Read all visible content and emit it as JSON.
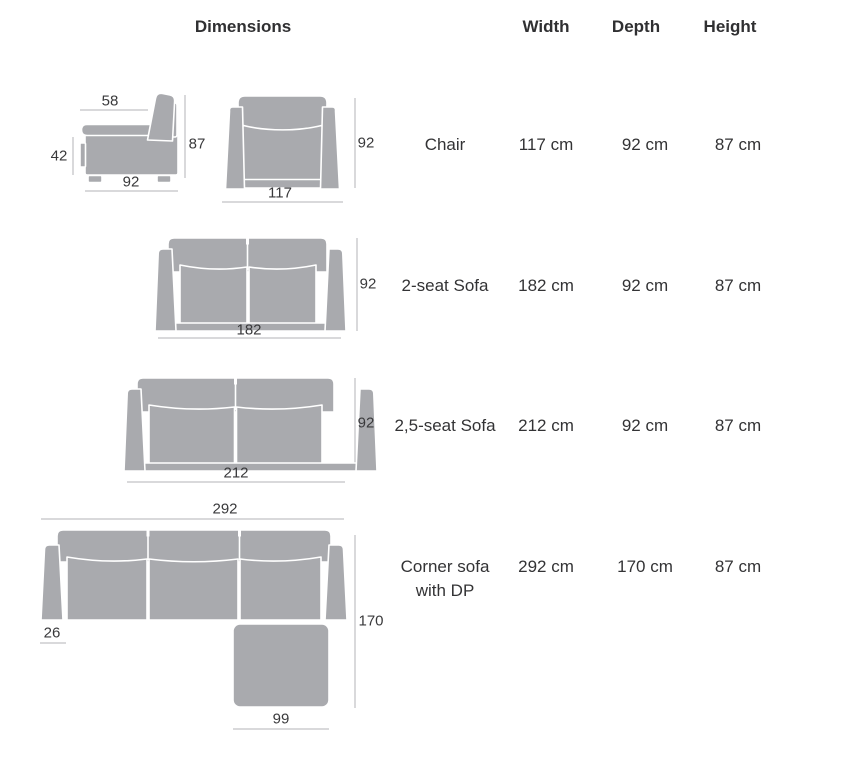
{
  "header": {
    "dimensions": "Dimensions",
    "width": "Width",
    "depth": "Depth",
    "height": "Height"
  },
  "rows": [
    {
      "name": "Chair",
      "name2": "",
      "width": "117 cm",
      "depth": "92 cm",
      "height": "87 cm"
    },
    {
      "name": "2-seat Sofa",
      "name2": "",
      "width": "182 cm",
      "depth": "92 cm",
      "height": "87 cm"
    },
    {
      "name": "2,5-seat Sofa",
      "name2": "",
      "width": "212 cm",
      "depth": "92 cm",
      "height": "87 cm"
    },
    {
      "name": "Corner sofa",
      "name2": "with DP",
      "width": "292 cm",
      "depth": "170 cm",
      "height": "87 cm"
    }
  ],
  "figures": {
    "chair_side": {
      "seat_depth": "58",
      "seat_height": "42",
      "total_height": "87",
      "total_depth": "92"
    },
    "chair_front": {
      "height": "92",
      "width": "117"
    },
    "sofa_2seat": {
      "height": "92",
      "width": "182"
    },
    "sofa_25seat": {
      "height": "92",
      "width": "212"
    },
    "corner_sofa": {
      "total_width": "292",
      "armrest_width": "26",
      "total_depth": "170",
      "chaise_width": "99"
    }
  },
  "colors": {
    "furniture_fill": "#a9aaae",
    "seam": "#ffffff",
    "dimension_line": "#b3b3b7",
    "text": "#323234"
  }
}
